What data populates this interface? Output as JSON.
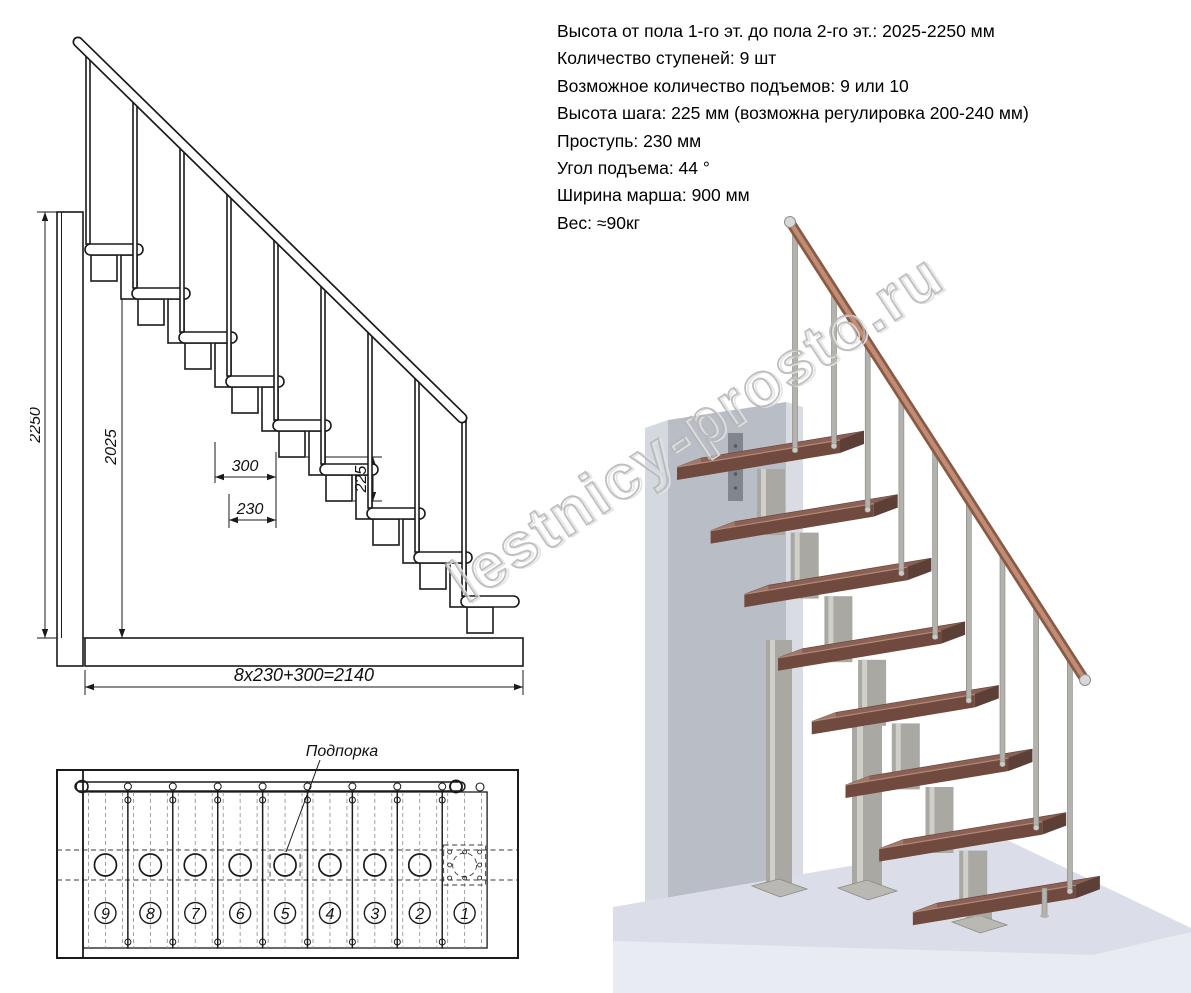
{
  "specs": {
    "lines": [
      "Высота от пола 1-го эт. до пола 2-го эт.: 2025-2250 мм",
      "Количество ступеней: 9 шт",
      "Возможное количество подъемов: 9 или 10",
      "Высота шага: 225 мм (возможна регулировка 200-240 мм)",
      "Проступь: 230 мм",
      "Угол подъема: 44 °",
      "Ширина марша: 900 мм",
      "Вес: ≈90кг"
    ]
  },
  "elevation": {
    "dims": {
      "total_height": "2250",
      "flight_height": "2025",
      "platform_depth": "300",
      "tread_depth": "230",
      "step_rise": "225",
      "total_run": "8x230+300=2140"
    }
  },
  "plan": {
    "support_label": "Подпорка",
    "step_numbers": [
      "9",
      "8",
      "7",
      "6",
      "5",
      "4",
      "3",
      "2",
      "1"
    ]
  },
  "watermark": {
    "text": "lestnicy-prosto.ru"
  },
  "colors": {
    "drawing_line": "#1a1a1a",
    "wood_step_top": "#8c6055",
    "wood_step_front": "#70493f",
    "wood_step_side": "#5c3f37",
    "wood_end_grain": "#a1796a",
    "handrail_wood": "#8a5a47",
    "handrail_highlight": "#c08d74",
    "metal": "#b3b2ac",
    "metal_highlight": "#d0cfc9",
    "wall_front": "#b9bdc6",
    "wall_side": "#d4d8df",
    "floor_top": "#dbdee8",
    "floor_front": "#e9ebf3",
    "watermark_gray": "#b6b6b6"
  }
}
